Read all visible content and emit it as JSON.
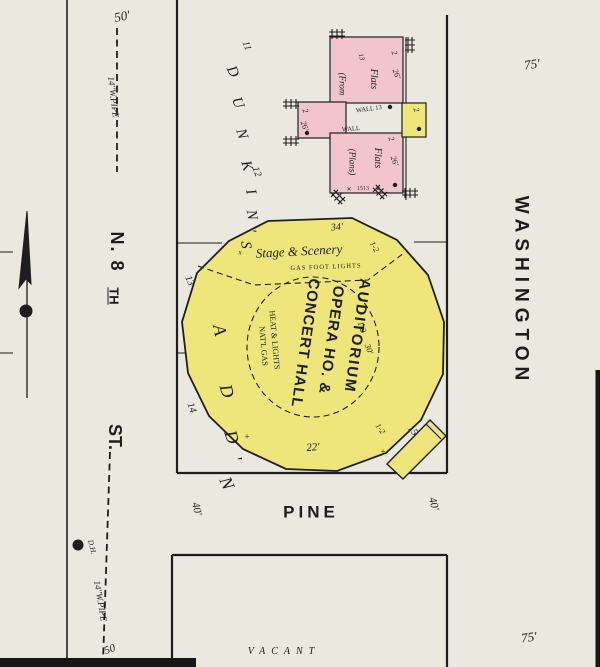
{
  "colors": {
    "paper": "#eae8df",
    "yellow": "#efe67b",
    "pink": "#f2c5cd",
    "ink": "#1e1e1e",
    "scan": "#161616"
  },
  "map_summary": {
    "streets": [
      "N. 8TH ST.",
      "PINE",
      "WASHINGTON"
    ],
    "addition_name": "DUNKIN'S ADD'N",
    "main_building": "AUDITORIUM OPERA HO. & CONCERT HALL",
    "other_buildings": "2 Flats (From Plans)",
    "vacant_label": "VACANT"
  },
  "annotations": [
    {
      "n": "dim-50ft-top",
      "t": "50'",
      "x": 122,
      "y": 16,
      "r": -12,
      "s": 13,
      "f": "i"
    },
    {
      "n": "water-pipe-label-top",
      "t": "14''W.PIPE",
      "x": 113,
      "y": 97,
      "r": 83,
      "s": 9,
      "f": "i"
    },
    {
      "n": "street-n8th-part1",
      "t": "N. 8",
      "x": 117,
      "y": 252,
      "r": 90,
      "s": 18,
      "f": "b",
      "ls": 2
    },
    {
      "n": "street-n8th-part2",
      "t": "TH",
      "x": 114,
      "y": 296,
      "r": 90,
      "s": 13,
      "f": "b",
      "u": true
    },
    {
      "n": "street-n8th-st",
      "t": "ST.",
      "x": 115,
      "y": 437,
      "r": 90,
      "s": 18,
      "f": "b"
    },
    {
      "n": "street-pine",
      "t": "PINE",
      "x": 311,
      "y": 512,
      "r": 0,
      "s": 17,
      "f": "b",
      "ls": 4
    },
    {
      "n": "street-washington",
      "t": "WASHINGTON",
      "x": 521,
      "y": 291,
      "r": 90,
      "s": 19,
      "f": "b",
      "ls": 6
    },
    {
      "n": "dim-75ft-top",
      "t": "75'",
      "x": 532,
      "y": 64,
      "r": -8,
      "s": 13,
      "f": "i"
    },
    {
      "n": "dim-75ft-bottom",
      "t": "75'",
      "x": 529,
      "y": 637,
      "r": -8,
      "s": 13,
      "f": "i"
    },
    {
      "n": "dim-50-bottom",
      "t": "50",
      "x": 110,
      "y": 650,
      "r": -20,
      "s": 11,
      "f": "i"
    },
    {
      "n": "water-pipe-label-bottom",
      "t": "14''W.PIPE",
      "x": 100,
      "y": 601,
      "r": 80,
      "s": 9,
      "f": "i"
    },
    {
      "n": "hydrant-label",
      "t": "D.H.",
      "x": 92,
      "y": 547,
      "r": 75,
      "s": 7.5,
      "f": "i"
    },
    {
      "n": "dim-40ft-left",
      "t": "40'",
      "x": 196,
      "y": 509,
      "r": 75,
      "s": 11,
      "f": "i"
    },
    {
      "n": "dim-40ft-right",
      "t": "40'",
      "x": 433,
      "y": 504,
      "r": 75,
      "s": 11,
      "f": "i"
    },
    {
      "n": "lot-number-11",
      "t": "11",
      "x": 246,
      "y": 46,
      "r": 70,
      "s": 10,
      "f": "i"
    },
    {
      "n": "lot-number-12",
      "t": "12",
      "x": 256,
      "y": 172,
      "r": 70,
      "s": 10,
      "f": "i"
    },
    {
      "n": "lot-number-13",
      "t": "13",
      "x": 189,
      "y": 281,
      "r": 65,
      "s": 10,
      "f": "i"
    },
    {
      "n": "lot-number-14",
      "t": "14",
      "x": 191,
      "y": 408,
      "r": 70,
      "s": 10,
      "f": "i"
    },
    {
      "n": "addition-letter-d1",
      "t": "D",
      "x": 232,
      "y": 72,
      "r": 64,
      "s": 15,
      "f": "i"
    },
    {
      "n": "addition-letter-u",
      "t": "U",
      "x": 237,
      "y": 103,
      "r": 68,
      "s": 15,
      "f": "i"
    },
    {
      "n": "addition-letter-n1",
      "t": "N",
      "x": 241,
      "y": 134,
      "r": 72,
      "s": 15,
      "f": "i"
    },
    {
      "n": "addition-letter-k",
      "t": "K",
      "x": 246,
      "y": 166,
      "r": 74,
      "s": 15,
      "f": "i"
    },
    {
      "n": "addition-letter-i",
      "t": "I",
      "x": 250,
      "y": 192,
      "r": 76,
      "s": 15,
      "f": "i"
    },
    {
      "n": "addition-letter-n2",
      "t": "N",
      "x": 251,
      "y": 215,
      "r": 80,
      "s": 15,
      "f": "i"
    },
    {
      "n": "addition-letter-apos1",
      "t": "'",
      "x": 250,
      "y": 231,
      "r": 82,
      "s": 15,
      "f": "i"
    },
    {
      "n": "addition-letter-s",
      "t": "S",
      "x": 245,
      "y": 245,
      "r": 86,
      "s": 15,
      "f": "i"
    },
    {
      "n": "addition-letter-a",
      "t": "A",
      "x": 220,
      "y": 330,
      "r": 78,
      "s": 18,
      "f": "i"
    },
    {
      "n": "addition-letter-d2",
      "t": "D",
      "x": 227,
      "y": 391,
      "r": 74,
      "s": 18,
      "f": "i"
    },
    {
      "n": "addition-letter-d3",
      "t": "D",
      "x": 232,
      "y": 437,
      "r": 72,
      "s": 18,
      "f": "i"
    },
    {
      "n": "addition-letter-apos2",
      "t": "'",
      "x": 236,
      "y": 459,
      "r": 70,
      "s": 18,
      "f": "i"
    },
    {
      "n": "addition-letter-n3",
      "t": "N",
      "x": 227,
      "y": 483,
      "r": 66,
      "s": 18,
      "f": "i"
    },
    {
      "n": "flats-from-label",
      "t": "(From",
      "x": 342,
      "y": 84,
      "r": 90,
      "s": 9,
      "f": "i"
    },
    {
      "n": "flats-upper-label",
      "t": "Flats",
      "x": 373,
      "y": 79,
      "r": 90,
      "s": 10,
      "f": "i"
    },
    {
      "n": "flats-upper-13",
      "t": "13",
      "x": 361,
      "y": 57,
      "r": 75,
      "s": 7,
      "f": "i"
    },
    {
      "n": "flats-upper-stories",
      "t": "2",
      "x": 394,
      "y": 53,
      "r": 70,
      "s": 8,
      "f": "i"
    },
    {
      "n": "flats-upper-26ft",
      "t": "26'",
      "x": 396,
      "y": 74,
      "r": 70,
      "s": 8,
      "f": "i"
    },
    {
      "n": "wall-13-label",
      "t": "WALL 13",
      "x": 369,
      "y": 110,
      "r": -8,
      "s": 6.5,
      "f": "s"
    },
    {
      "n": "flats-wing-stories",
      "t": "2",
      "x": 305,
      "y": 111,
      "r": 70,
      "s": 8,
      "f": "i"
    },
    {
      "n": "flats-wing-26ft",
      "t": "26'",
      "x": 304,
      "y": 126,
      "r": 70,
      "s": 8,
      "f": "i"
    },
    {
      "n": "wall-label",
      "t": "WALL",
      "x": 351,
      "y": 130,
      "r": -5,
      "s": 6.5,
      "f": "s"
    },
    {
      "n": "flats-lower-label",
      "t": "Flats",
      "x": 377,
      "y": 158,
      "r": 90,
      "s": 10,
      "f": "i"
    },
    {
      "n": "flats-plans-label",
      "t": "(Plans)",
      "x": 352,
      "y": 162,
      "r": 90,
      "s": 9,
      "f": "i"
    },
    {
      "n": "flats-lower-stories",
      "t": "2",
      "x": 391,
      "y": 139,
      "r": 70,
      "s": 8,
      "f": "i"
    },
    {
      "n": "flats-lower-26ft",
      "t": "26'",
      "x": 394,
      "y": 161,
      "r": 70,
      "s": 8,
      "f": "i"
    },
    {
      "n": "flats-house-number",
      "t": "1513",
      "x": 363,
      "y": 189,
      "r": 0,
      "s": 6,
      "f": "s"
    },
    {
      "n": "mark-x-left",
      "t": "✕",
      "x": 349,
      "y": 190,
      "r": 0,
      "s": 6,
      "f": "s"
    },
    {
      "n": "mark-x-right",
      "t": "✕",
      "x": 378,
      "y": 190,
      "r": 0,
      "s": 6,
      "f": "s"
    },
    {
      "n": "yellow-annex-stories",
      "t": "2",
      "x": 416,
      "y": 110,
      "r": 70,
      "s": 8,
      "f": "i"
    },
    {
      "n": "auditorium-34ft",
      "t": "34'",
      "x": 337,
      "y": 228,
      "r": -5,
      "s": 10,
      "f": "i"
    },
    {
      "n": "stage-scenery-label",
      "t": "Stage & Scenery",
      "x": 299,
      "y": 251,
      "r": -3,
      "s": 13,
      "f": "i"
    },
    {
      "n": "gas-footlights-label",
      "t": "GAS FOOT LIGHTS",
      "x": 326,
      "y": 268,
      "r": -2,
      "s": 6.5,
      "f": "s",
      "ls": 1
    },
    {
      "n": "height-1-2-topright",
      "t": "1-2",
      "x": 374,
      "y": 247,
      "r": 60,
      "s": 8,
      "f": "i"
    },
    {
      "n": "auditorium-title-line1",
      "t": "AUDITORIUM",
      "x": 357,
      "y": 336,
      "r": 98,
      "s": 15,
      "f": "bc",
      "ls": 2
    },
    {
      "n": "auditorium-title-line2",
      "t": "OPERA HO. &",
      "x": 331,
      "y": 340,
      "r": 98,
      "s": 15,
      "f": "bc",
      "ls": 1
    },
    {
      "n": "auditorium-title-line3",
      "t": "CONCERT HALL",
      "x": 305,
      "y": 343,
      "r": 98,
      "s": 15,
      "f": "bc",
      "ls": 1
    },
    {
      "n": "heat-lights-label",
      "t": "HEAT & LIGHTS",
      "x": 274,
      "y": 340,
      "r": 85,
      "s": 8,
      "f": "s"
    },
    {
      "n": "natl-gas-label",
      "t": "NAT'L GAS",
      "x": 263,
      "y": 346,
      "r": 85,
      "s": 8,
      "f": "s"
    },
    {
      "n": "height-1-2-center",
      "t": "1-2",
      "x": 362,
      "y": 327,
      "r": 70,
      "s": 8.5,
      "f": "i"
    },
    {
      "n": "height-30ft-center",
      "t": "30'",
      "x": 369,
      "y": 349,
      "r": 70,
      "s": 8.5,
      "f": "i"
    },
    {
      "n": "auditorium-22ft",
      "t": "22'",
      "x": 313,
      "y": 448,
      "r": -5,
      "s": 11,
      "f": "i"
    },
    {
      "n": "mark-plus-left",
      "t": "+",
      "x": 247,
      "y": 437,
      "r": 0,
      "s": 9,
      "f": "s"
    },
    {
      "n": "mark-plus-right",
      "t": "+",
      "x": 383,
      "y": 452,
      "r": 0,
      "s": 9,
      "f": "s"
    },
    {
      "n": "mark-x-stage",
      "t": "x",
      "x": 240,
      "y": 253,
      "r": 0,
      "s": 7,
      "f": "i"
    },
    {
      "n": "annex-15ft",
      "t": "15",
      "x": 412,
      "y": 431,
      "r": 50,
      "s": 10,
      "f": "i"
    },
    {
      "n": "annex-1-2",
      "t": "1-2",
      "x": 380,
      "y": 429,
      "r": 55,
      "s": 8,
      "f": "i"
    },
    {
      "n": "vacant-label",
      "t": "VACANT",
      "x": 284,
      "y": 652,
      "r": 0,
      "s": 10,
      "f": "i",
      "ls": 6
    }
  ]
}
